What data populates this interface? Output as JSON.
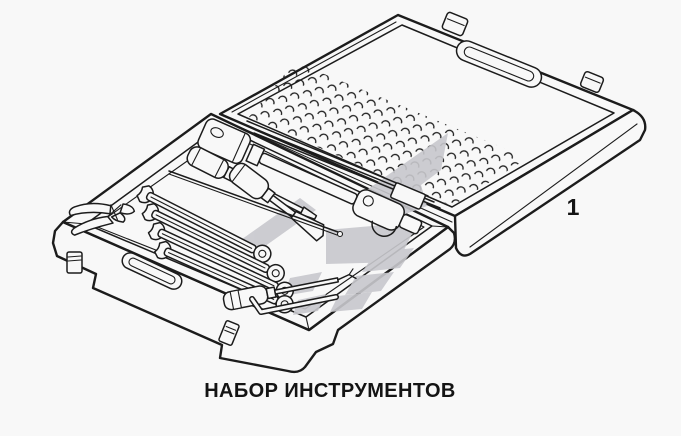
{
  "figure": {
    "caption": "НАБОР ИНСТРУМЕНТОВ",
    "callout_number": "1"
  },
  "colors": {
    "background": "#f8f8f8",
    "line": "#1c1c1c",
    "watermark": "#c8c8cd"
  }
}
